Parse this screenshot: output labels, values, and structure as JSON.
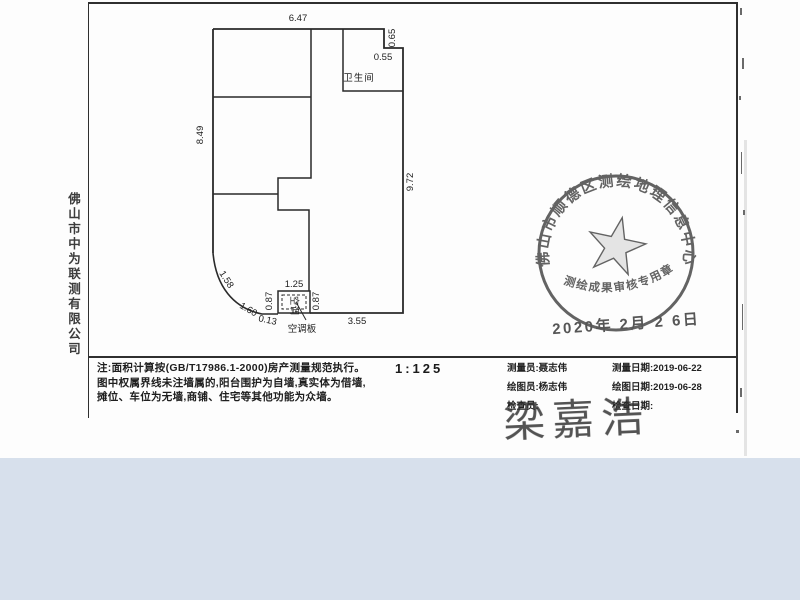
{
  "colors": {
    "paper": "#fdfdfd",
    "ink": "#2a2a2a",
    "stamp": "#4a4a4a",
    "band": "#d7e0ec"
  },
  "document": {
    "company_vertical": "佛山市中为联测有限公司",
    "scale_label": "1:125",
    "notes": [
      "注:面积计算按(GB/T17986.1-2000)房产测量规范执行。",
      "图中权属界线未注墙属的,阳台围护为自墙,真实体为借墙,",
      "摊位、车位为无墙,商铺、住宅等其他功能为众墙。"
    ]
  },
  "floorplan": {
    "labels": {
      "bathroom": "卫生间",
      "ac_panel": "空调板",
      "ac_inner": "空调"
    },
    "dims": {
      "top": "6.47",
      "step_height": "0.65",
      "step_width": "0.55",
      "left": "8.49",
      "right": "9.72",
      "arc_upper": "1.58",
      "arc_lower": "1.60",
      "arc_end": "0.13",
      "box_left": "0.87",
      "box_top": "1.25",
      "box_right": "0.87",
      "bottom": "3.55"
    }
  },
  "table": {
    "cells": [
      [
        "测量员:聂志伟",
        "测量日期:2019-06-22"
      ],
      [
        "绘图员:杨志伟",
        "绘图日期:2019-06-28"
      ],
      [
        "检查员:",
        "检查日期:"
      ]
    ]
  },
  "signature": "梁嘉浩",
  "stamp": {
    "ring_text": "佛山市顺德区测绘地理信息中心",
    "bottom_text": "测绘成果审核专用章",
    "date": "2020年 2月 2 6日"
  }
}
